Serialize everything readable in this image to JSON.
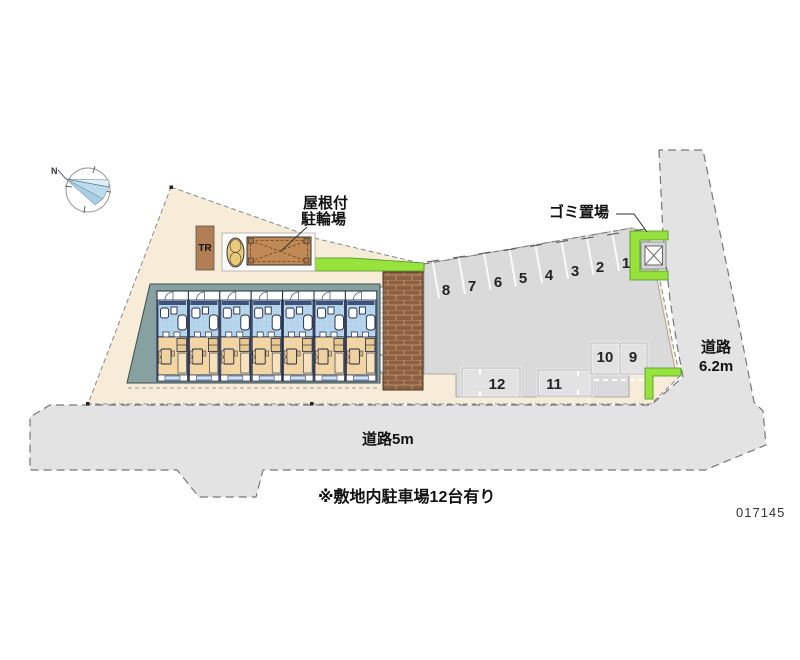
{
  "labels": {
    "bicycle_parking_1": "屋根付",
    "bicycle_parking_2": "駐輪場",
    "garbage": "ゴミ置場",
    "road_right_1": "道路",
    "road_right_2": "6.2m",
    "road_bottom": "道路5m",
    "note": "※敷地内駐車場12台有り",
    "plan_no": "017145",
    "transformer": "TR",
    "compass_north": "N"
  },
  "parking": {
    "row_numbers": [
      "8",
      "7",
      "6",
      "5",
      "4",
      "3",
      "2",
      "1"
    ],
    "lower_numbers": [
      "12",
      "11",
      "10",
      "9"
    ]
  },
  "colors": {
    "site_beige": "#f6ecd8",
    "road_gray": "#e3e3e3",
    "parking_gray": "#dadada",
    "hedge_green": "#97e23c",
    "unit_wet_area_blue": "#b9d7ec",
    "unit_room_tan": "#f2d5a2",
    "brick_brown": "#8d5f43",
    "building_frame_teal": "#87a0a0"
  }
}
